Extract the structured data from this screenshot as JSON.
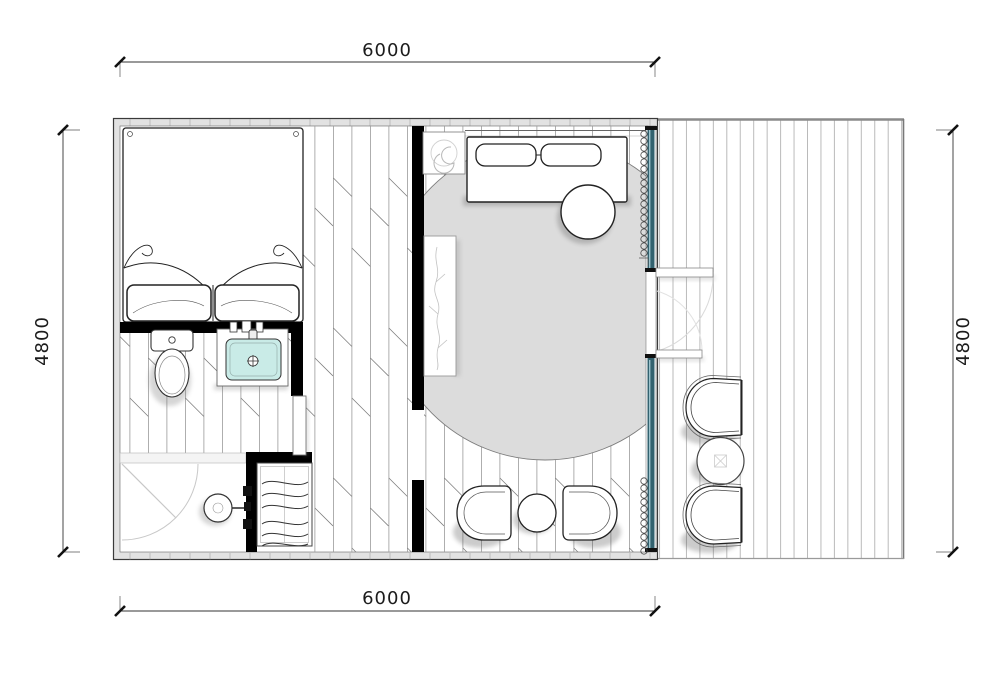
{
  "title": "cabin-floor-plan",
  "annotations": {
    "dim_top": "6000",
    "dim_bottom": "6000",
    "dim_left": "4800",
    "dim_right": "4800"
  },
  "colors": {
    "wall": "#000000",
    "wallband": "#e2e2e2",
    "glass": "#33626f",
    "glasshi": "#9cc3cd",
    "sink": "#c9ebe7",
    "rug": "#dcdcdc",
    "plankline": "#9a9a9a",
    "deckline": "#bababa",
    "line": "#222222",
    "faint": "#cdcdcd"
  },
  "elements": [
    "double-bed",
    "pillows",
    "toilet",
    "vanity-sink",
    "shower-head",
    "shower-door",
    "wardrobe-closet",
    "sofa",
    "sofa-cushions",
    "round-side-table",
    "spiral-side-table",
    "plant-stand",
    "round-rug",
    "lounge-chairs",
    "bistro-table",
    "glass-wall",
    "curtain",
    "entry-steps",
    "deck-armchairs",
    "deck-round-table",
    "wood-deck"
  ]
}
